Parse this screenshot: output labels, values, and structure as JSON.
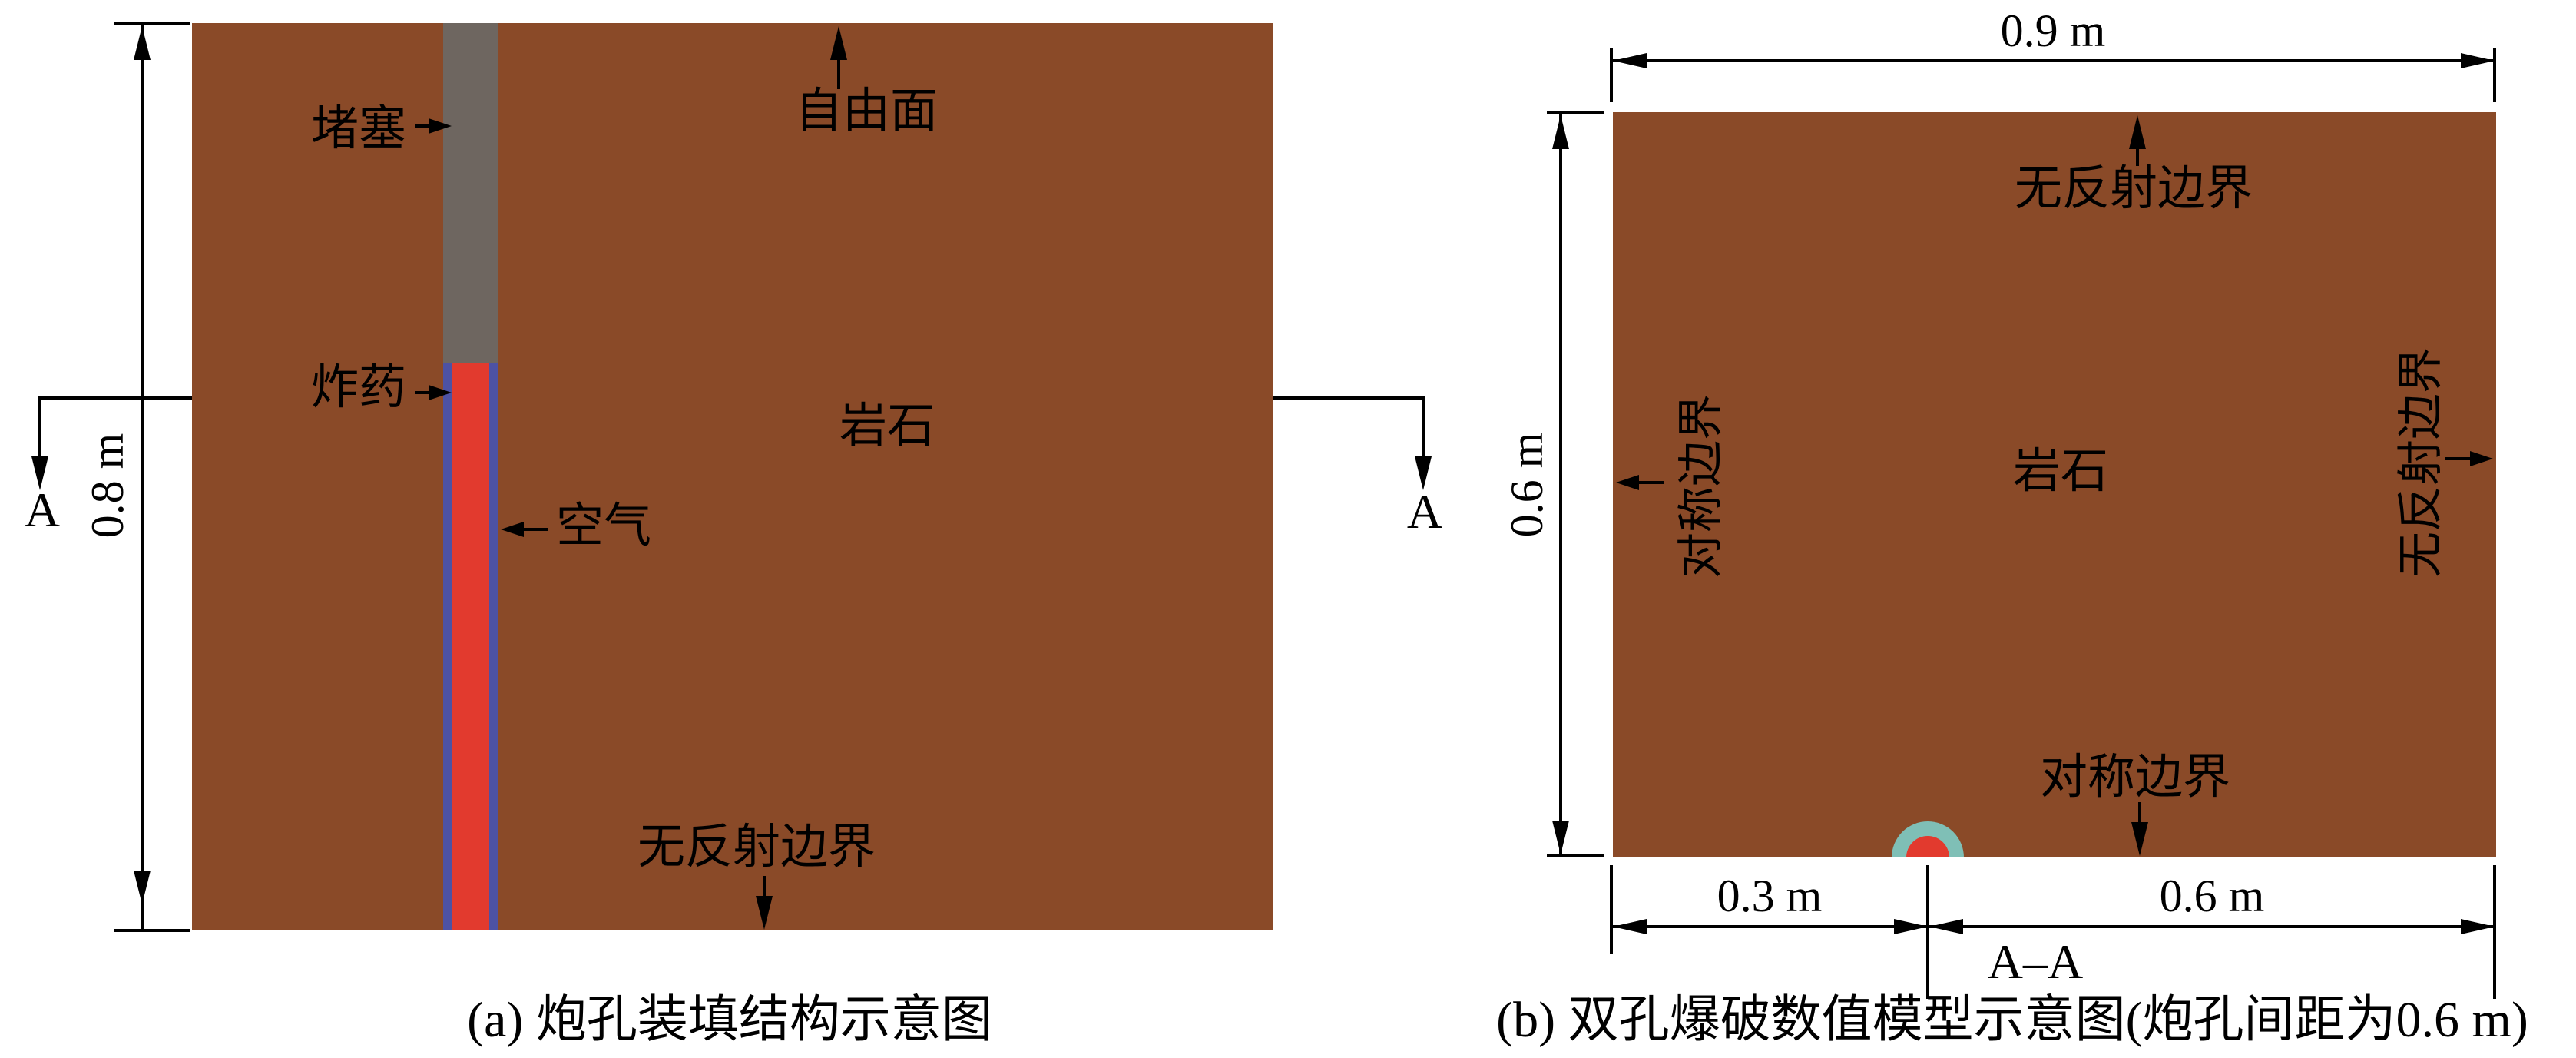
{
  "colors": {
    "rock": "#8a4a28",
    "stemming_gray": "#6e6660",
    "explosive_red": "#e23a2e",
    "air_blue": "#4d52a4",
    "borehole_ring_teal": "#7fbfb6",
    "line": "#000000",
    "background": "#ffffff"
  },
  "diagram_a": {
    "caption": "(a) 炮孔装填结构示意图",
    "dim_height": "0.8 m",
    "section_label_left": "A",
    "section_label_right": "A",
    "labels": {
      "stemming": "堵塞",
      "explosive": "炸药",
      "air": "空气",
      "free_surface": "自由面",
      "rock": "岩石",
      "non_reflective_bottom": "无反射边界"
    }
  },
  "diagram_b": {
    "caption": "(b) 双孔爆破数值模型示意图(炮孔间距为0.6 m)",
    "dim_width_top": "0.9 m",
    "dim_height_left": "0.6 m",
    "dim_bottom_left": "0.3 m",
    "dim_bottom_right": "0.6 m",
    "section_label": "A–A",
    "labels": {
      "top": "无反射边界",
      "left": "对称边界",
      "right": "无反射边界",
      "bottom": "对称边界",
      "rock": "岩石"
    }
  }
}
